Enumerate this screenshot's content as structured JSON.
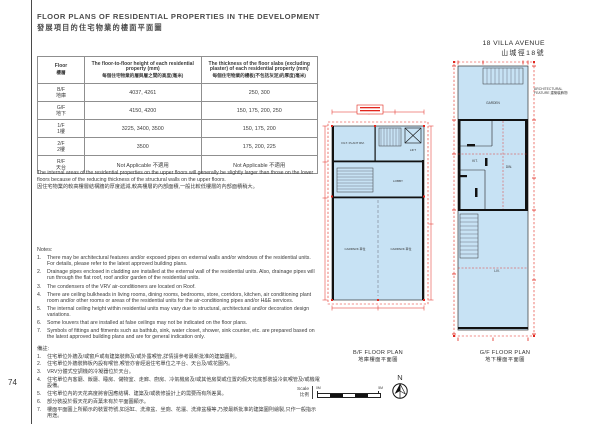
{
  "page": {
    "number": "74"
  },
  "header": {
    "title_en": "FLOOR PLANS OF RESIDENTIAL PROPERTIES IN THE DEVELOPMENT",
    "title_zh": "發展項目的住宅物業的樓面平面圖"
  },
  "table": {
    "col1_en": "Floor",
    "col1_zh": "樓層",
    "col2_en": "The floor-to-floor height of each residential property (mm)",
    "col2_zh": "每個住宅物業的層與層之間的高度(毫米)",
    "col3_en": "The thickness of the floor slabs (excluding plaster) of each residential property (mm)",
    "col3_zh": "每個住宅物業的樓板(不包括灰泥)的厚度(毫米)",
    "rows": [
      {
        "floor_en": "B/F",
        "floor_zh": "地庫",
        "height": "4037, 4261",
        "thickness": "250, 300"
      },
      {
        "floor_en": "G/F",
        "floor_zh": "地下",
        "height": "4150, 4200",
        "thickness": "150, 175, 200, 250"
      },
      {
        "floor_en": "1/F",
        "floor_zh": "1樓",
        "height": "3225, 3400, 3500",
        "thickness": "150, 175, 200"
      },
      {
        "floor_en": "2/F",
        "floor_zh": "2樓",
        "height": "3500",
        "thickness": "175, 200, 225"
      },
      {
        "floor_en": "R/F",
        "floor_zh": "天台",
        "height": "Not Applicable 不適用",
        "thickness": "Not Applicable 不適用"
      }
    ]
  },
  "remark": {
    "en": "The internal areas of the residential properties on the upper floors will generally be slightly larger than those on the lower floors because of the reducing thickness of the structural walls on the upper floors.",
    "zh": "因住宅物業的較高樓層結構牆的厚度遞減,較高樓層的內部面積,一般比較低樓層的內部面積稍大。"
  },
  "notes": {
    "label_en": "Notes:",
    "items_en": [
      {
        "n": "1.",
        "t": "There may be architectural features and/or exposed pipes on external walls and/or windows of the residential units. For details, please refer to the latest approved building plans."
      },
      {
        "n": "2.",
        "t": "Drainage pipes enclosed in cladding are installed at the external wall of the residential units. Also, drainage pipes will run through the flat roof, roof and/or garden of the residential units."
      },
      {
        "n": "3.",
        "t": "The condensers of the VRV air-conditioners are located on Roof."
      },
      {
        "n": "4.",
        "t": "There are ceiling bulkheads in living rooms, dining rooms, bedrooms, store, corridors, kitchen, air conditioning plant room and/or other rooms or areas of the residential units for the air-conditioning pipes and/or H&E services."
      },
      {
        "n": "5.",
        "t": "The internal ceiling height within residential units may vary due to structural, architectural and/or decoration design variations."
      },
      {
        "n": "6.",
        "t": "Some louvers that are installed at false ceilings may not be indicated on the floor plans."
      },
      {
        "n": "7.",
        "t": "Symbols of fittings and fitments such as bathtub, sink, water closet, shower, sink counter, etc. are prepared based on the latest approved building plans and are for general indication only."
      }
    ],
    "label_zh": "備註:",
    "items_zh": [
      {
        "n": "1.",
        "t": "住宅單位外牆及/或窗戶或有建築裝飾及/或外露喉管,詳情請參考最新批准的建築圖則。"
      },
      {
        "n": "2.",
        "t": "住宅單位外牆裝飾板內設有喉管,喉管亦會經過住宅單位之平台、天台及/或花園內。"
      },
      {
        "n": "3.",
        "t": "VRV分體式空調機的冷凝器位於天台。"
      },
      {
        "n": "4.",
        "t": "住宅單位內客廳、飯廳、睡房、儲物室、走廊、廚房、冷氣機房及/或其他房間或位置的假天花底部裝設冷氣喉管及/或機電設備。"
      },
      {
        "n": "5.",
        "t": "住宅單位內的天花高度將會因應結構、建築及/或裝修設計上的需要而有所差異。"
      },
      {
        "n": "6.",
        "t": "部分裝設於假天花的百葉未有於平面圖顯示。"
      },
      {
        "n": "7.",
        "t": "樓面平面圖上所顯示的裝置符號,如浴缸、洗滌盆、坐廁、花灑、洗滌盆檯等,乃按最新批准的建築圖則繪製,只作一般指示用途。"
      }
    ]
  },
  "plans": {
    "building_en": "18 VILLA AVENUE",
    "building_zh": "山城徑18號",
    "bf_caption_en": "B/F FLOOR PLAN",
    "bf_caption_zh": "地庫樓面平面圖",
    "gf_caption_en": "G/F FLOOR PLAN",
    "gf_caption_zh": "地下樓面平面圖",
    "annotation": "ARCHITECTURAL FEATURE 建築裝飾物",
    "gf_rooms": {
      "garden_top": "GARDEN",
      "kit": "KIT.",
      "din": "DIN.",
      "liv": "LIV."
    },
    "bf_rooms": {
      "plant": "FILT. PLANT RM.",
      "lift": "LIFT",
      "lobby": "LOBBY",
      "car1": "CARPARK 車位",
      "car2": "CARPARK 車位"
    }
  },
  "scale": {
    "label_en": "Scale",
    "label_zh": "比例",
    "min": "0M",
    "max": "5M"
  },
  "compass": {
    "label": "N"
  },
  "colors": {
    "plan_fill": "#c7e2f4",
    "dim_red": "#e2251c",
    "wall": "#111111",
    "text": "#3b3b3b"
  }
}
